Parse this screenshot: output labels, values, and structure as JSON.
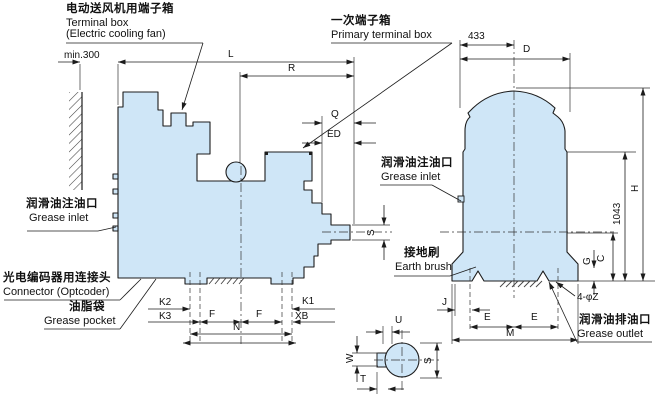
{
  "drawing": {
    "kind": "motor outline dimension drawing",
    "views": [
      "side view",
      "end view",
      "shaft end detail"
    ]
  },
  "colors": {
    "body_fill": "#cfe6f7",
    "line": "#1c1c1c",
    "background": "#ffffff"
  },
  "labels": {
    "fan_box_cn": "电动送风机用端子箱",
    "fan_box_en1": "Terminal box",
    "fan_box_en2": "(Electric cooling fan)",
    "primary_box_cn": "一次端子箱",
    "primary_box_en": "Primary terminal box",
    "grease_inlet_left_cn": "润滑油注油口",
    "grease_inlet_left_en": "Grease inlet",
    "grease_inlet_right_cn": "润滑油注油口",
    "grease_inlet_right_en": "Grease inlet",
    "connector_cn": "光电编码器用连接头",
    "connector_en": "Connector (Optcoder)",
    "grease_pocket_cn": "油脂袋",
    "grease_pocket_en": "Grease pocket",
    "earth_brush_cn": "接地刷",
    "earth_brush_en": "Earth brush",
    "grease_outlet_cn": "润滑油排油口",
    "grease_outlet_en": "Grease outlet",
    "min300": "min.300",
    "L": "L",
    "R": "R",
    "Q": "Q",
    "ED": "ED",
    "n433": "433",
    "D": "D",
    "S_side": "S",
    "S_shaft": "S",
    "K2": "K2",
    "K3": "K3",
    "K1": "K1",
    "XB": "XB",
    "F1": "F",
    "F2": "F",
    "N": "N",
    "H": "H",
    "n1043": "1043",
    "G": "G",
    "C": "C",
    "J": "J",
    "E1": "E",
    "E2": "E",
    "M": "M",
    "phiZ": "4-φZ",
    "U": "U",
    "W": "W",
    "T": "T"
  }
}
